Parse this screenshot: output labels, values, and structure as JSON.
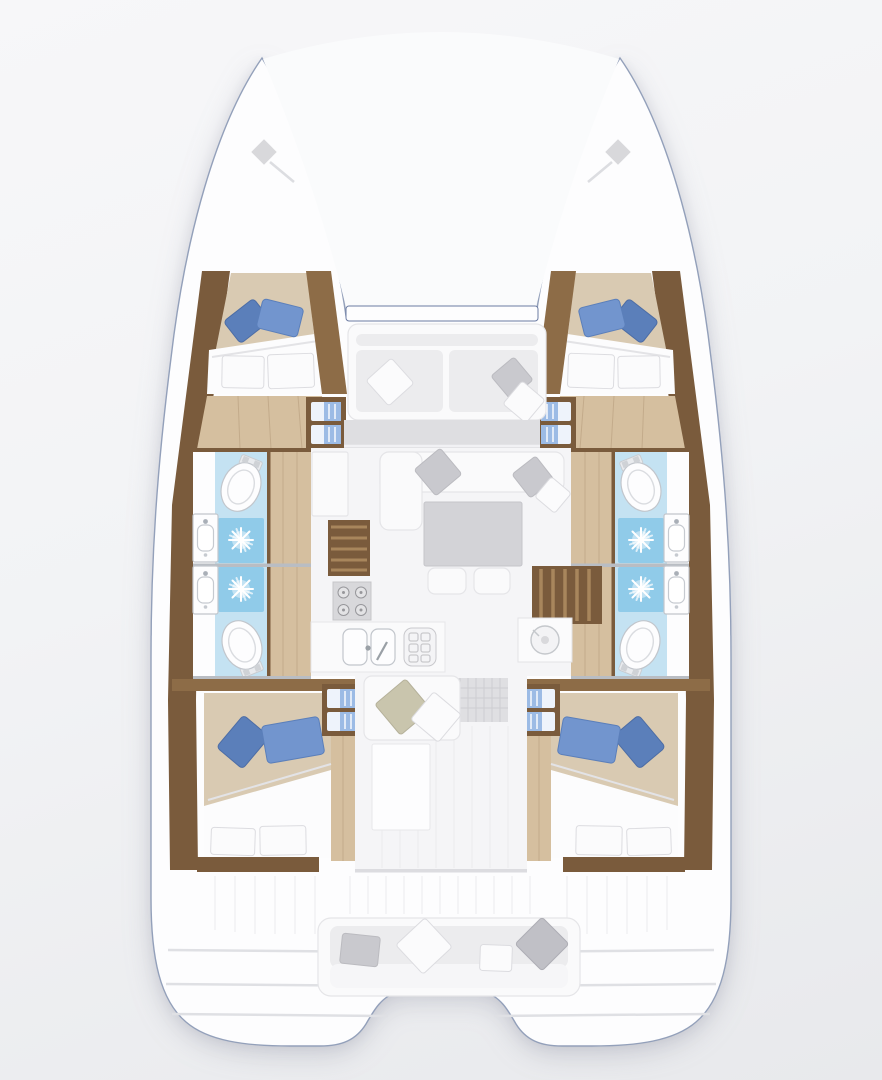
{
  "meta": {
    "kind": "boat-floor-plan",
    "view": "top-down",
    "vessel": "sailing-catamaran",
    "visible_text": []
  },
  "palette": {
    "background": "#f2f3f5",
    "hull_fill": "#fdfdfe",
    "hull_outline": "#93a0ba",
    "hull_outline_dark": "#6b7ba2",
    "trampoline": "#fafbfc",
    "wood_dark": "#7a5b3c",
    "wood_mid": "#8d6c47",
    "wood_light": "#a8865c",
    "floor_tan": "#d5bf9f",
    "bed_beige": "#d9cab2",
    "duvet_white": "#fcfcfd",
    "pillow_blue": "#7295ce",
    "pillow_blue_dark": "#5b7fba",
    "pillow_white": "#fbfbfc",
    "pillow_gray": "#c9c9ce",
    "pillow_olive": "#c9c5ad",
    "bath_counter": "#c4e2f2",
    "shower_blue": "#90cbe9",
    "fixture_white": "#fdfdfe",
    "fixture_line": "#c2c6cc",
    "step_blue": "#9cbbe5",
    "step_white": "#eef3fb",
    "sofa_white": "#fafafb",
    "cushion_gray": "#ececee",
    "table_gray": "#d3d3d7",
    "appliance_gray": "#d8d8db",
    "line_soft": "#e5e5e8",
    "plank_line": "#ebebee",
    "divider": "#b9bdc3"
  },
  "structure": {
    "hulls": [
      {
        "id": "port",
        "rooms": [
          {
            "name": "forward-cabin",
            "features": [
              "double-berth",
              "two-blue-pillows",
              "two-white-pillows",
              "entry-steps",
              "wood-sole"
            ]
          },
          {
            "name": "forward-bathroom",
            "features": [
              "toilet",
              "washbasin",
              "shower"
            ]
          },
          {
            "name": "aft-bathroom",
            "features": [
              "toilet",
              "washbasin",
              "shower"
            ]
          },
          {
            "name": "aft-cabin",
            "features": [
              "double-berth",
              "two-blue-pillows",
              "two-white-pillows",
              "entry-steps",
              "wood-sole"
            ]
          }
        ]
      },
      {
        "id": "starboard",
        "mirror_of": "port",
        "rooms": [
          {
            "name": "forward-cabin",
            "features": [
              "double-berth",
              "two-blue-pillows",
              "two-white-pillows",
              "entry-steps",
              "wood-sole"
            ]
          },
          {
            "name": "forward-bathroom",
            "features": [
              "toilet",
              "washbasin",
              "shower"
            ]
          },
          {
            "name": "aft-bathroom",
            "features": [
              "toilet",
              "washbasin",
              "shower"
            ]
          },
          {
            "name": "aft-cabin",
            "features": [
              "double-berth",
              "two-blue-pillows",
              "two-white-pillows",
              "entry-steps",
              "wood-sole"
            ]
          }
        ]
      }
    ],
    "bridgedeck": [
      {
        "name": "bow-trampoline",
        "features": []
      },
      {
        "name": "forward-cockpit",
        "features": [
          "bench-seat",
          "two-seat-cushions",
          "three-scatter-pillows"
        ]
      },
      {
        "name": "saloon",
        "features": [
          "l-shaped-sofa",
          "gray-coffee-table",
          "two-stools",
          "scatter-pillows",
          "cabinet"
        ]
      },
      {
        "name": "companionways",
        "features": [
          "port-wood-steps",
          "starboard-wood-steps"
        ]
      },
      {
        "name": "galley",
        "features": [
          "four-burner-hob",
          "double-sink",
          "dish-rack",
          "round-sink-island",
          "bench-seat",
          "chaise-pad",
          "entry-mat"
        ]
      },
      {
        "name": "aft-cockpit",
        "features": [
          "full-width-bench",
          "four-scatter-pillows",
          "plank-deck"
        ]
      },
      {
        "name": "sterns",
        "features": [
          "port-swim-platform",
          "starboard-swim-platform",
          "transom-steps"
        ]
      }
    ],
    "totals": {
      "cabins": 4,
      "bathrooms": 4,
      "showers": 4,
      "toilets": 4,
      "washbasins": 4
    }
  }
}
